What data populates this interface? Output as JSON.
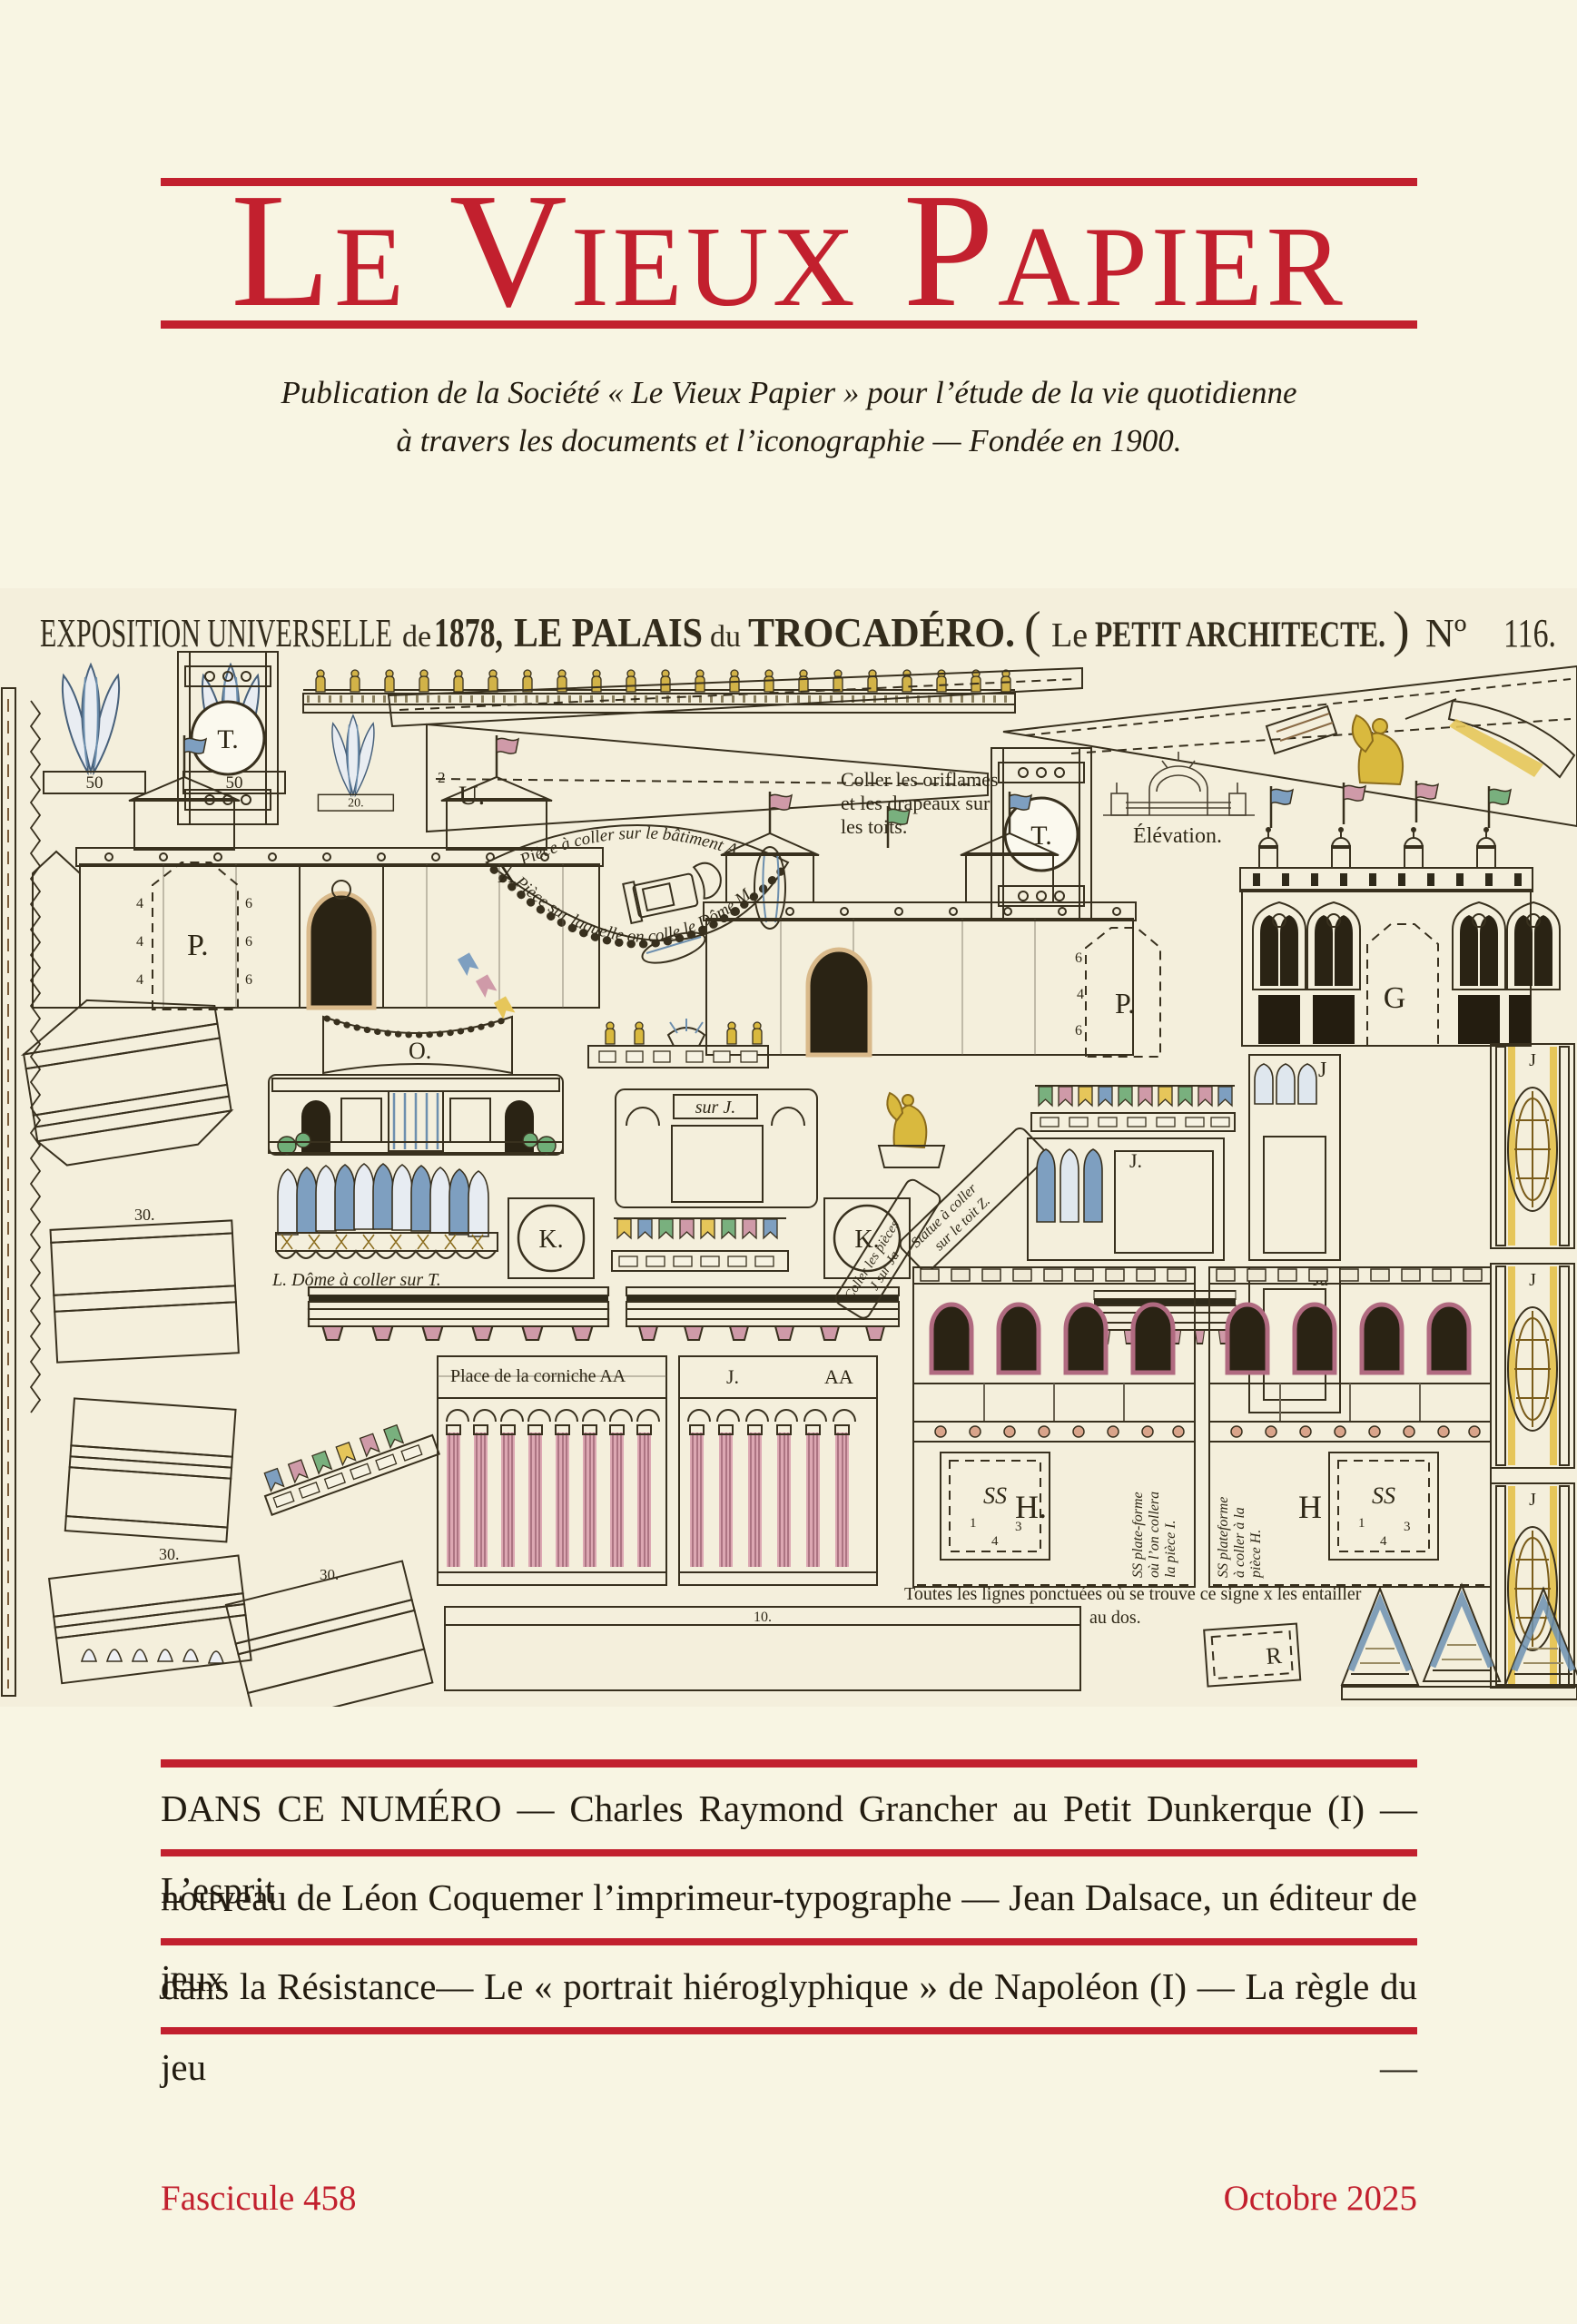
{
  "colors": {
    "red": "#c2202e",
    "paper": "#f8f5e3",
    "plate_paper": "#f4efdc",
    "ink": "#221b10"
  },
  "masthead": {
    "title": "Le Vieux Papier",
    "subtitle1": "Publication de la Société « Le Vieux Papier » pour l’étude de la vie quotidienne",
    "subtitle2": "à travers les documents et l’iconographie  —  Fondée en 1900."
  },
  "plate": {
    "header": {
      "h1": "EXPOSITION UNIVERSELLE",
      "h2": "de",
      "h3": "1878,",
      "h4": "LE PALAIS",
      "h5": "du",
      "h6": "TROCADÉRO.",
      "h7": "(",
      "h8": "Le",
      "h9": "PETIT ARCHITECTE.",
      "h10": ")",
      "h11": "Nº",
      "h12": "116."
    },
    "ann": {
      "oriflames1": "Coller les oriflames",
      "oriflames2": "et les drapeaux sur",
      "oriflames3": "les toits.",
      "elevation": "Élévation.",
      "arc_top": "Pièce à coller sur le bâtiment A",
      "arc_bottom": "Pièce sur laquelle on colle le Dôme M.",
      "dome": "L. Dôme à coller sur T.",
      "sur_j": "sur J.",
      "statue1": "Statue à coller",
      "statue2": "sur le toit Z.",
      "coller_j1": "Coller les pièces",
      "coller_j2": "J sur Ja",
      "corniche": "Place de la corniche AA",
      "ss_i1": "SS plate-forme",
      "ss_i2": "où l’on collera",
      "ss_i3": "la pièce I.",
      "ss_h1": "SS plateforme",
      "ss_h2": "à coller à la",
      "ss_h3": "pièce H.",
      "lignes1": "Toutes les lignes ponctuées où se trouve ce signe x les entailler",
      "lignes2": "au dos."
    },
    "labels": {
      "t": "T.",
      "u": "U.",
      "p": "P.",
      "x": "X",
      "g": "G",
      "o": "O.",
      "k": "K.",
      "j": "J",
      "jdot": "J.",
      "ja": "Ja",
      "h": "H.",
      "h2": "H",
      "ss": "SS",
      "aa": "AA",
      "r": "R",
      "n1": "1",
      "n2": "2",
      "n3": "3",
      "n4": "4",
      "n6": "6",
      "n10": "10.",
      "n20": "20.",
      "n30": "30.",
      "n50": "50"
    }
  },
  "contents": {
    "lines": [
      "DANS CE NUMÉRO — Charles Raymond Grancher au Petit Dunkerque (I) — L’esprit",
      "nouveau de Léon Coquemer l’imprimeur-typographe — Jean Dalsace, un éditeur de jeux",
      "dans la Résistance— Le « portrait hiéroglyphique » de Napoléon (I) — La règle du jeu  —"
    ]
  },
  "footer": {
    "left": "Fascicule 458",
    "right": "Octobre 2025"
  }
}
